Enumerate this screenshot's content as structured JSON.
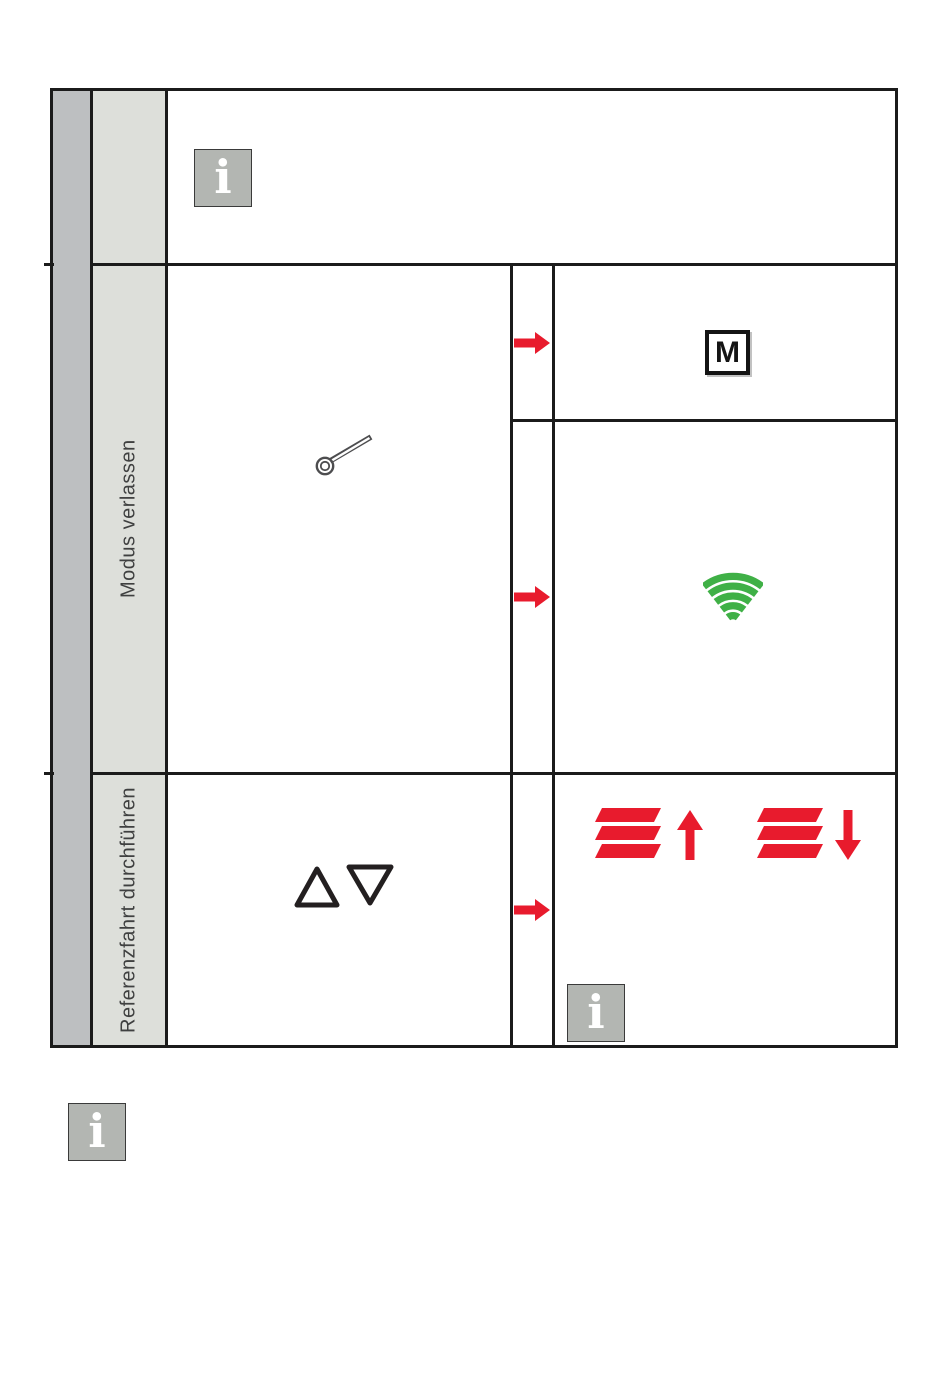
{
  "page_type": "instruction-manual-table",
  "colors": {
    "red": "#E81B2D",
    "green": "#3FB046",
    "sidebar_dark": "#BDBFC1",
    "sidebar_light": "#DDDFDA",
    "info_icon_bg": "#B3B6B2",
    "table_border": "#1B1B1B",
    "label_text": "#3F4040"
  },
  "table": {
    "row_note": {
      "info_icon_glyph": "i"
    },
    "row_modus": {
      "label": "Modus verlassen",
      "tool_icon": "reset-pin",
      "step1": {
        "arrow_icon": "red-right-arrow",
        "result_symbol": "M"
      },
      "step2": {
        "arrow_icon": "red-right-arrow",
        "result_icon": "green-radio-signal"
      }
    },
    "row_referenz": {
      "label": "Referenzfahrt durchführen",
      "buttons_icon": "triangle-up-down-buttons",
      "arrow_icon": "red-right-arrow",
      "result_icons": [
        "shutter-slats-up",
        "shutter-slats-down"
      ],
      "info_icon_glyph": "i"
    }
  },
  "footer": {
    "info_icon_glyph": "i"
  }
}
